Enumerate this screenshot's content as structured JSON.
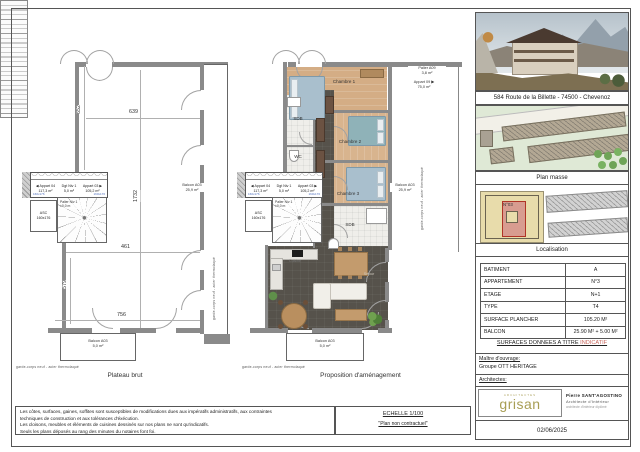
{
  "plans": {
    "left_title": "Plateau brut",
    "right_title": "Proposition d'aménagement",
    "rooms": {
      "chambre1": "Chambre 1",
      "chambre2": "Chambre 2",
      "chambre3": "Chambre 3",
      "sdb": "SDB",
      "wc": "WC",
      "sdb2": "SDB",
      "cuisine": "Cuisine",
      "sejour": "Séjour"
    },
    "labels": {
      "arrow_left": "◀",
      "arrow_right": "▶",
      "appart_04": "Appart 04",
      "appart_04_area": "117,3 m²",
      "appart_03": "Appart 03",
      "appart_03_area": "105,2 m²",
      "dgt_niv1": "Dgt Niv 1",
      "dgt_niv1_area": "5,0 m²",
      "asc": "ASC",
      "asc_dim": "160x176",
      "palier_niv1": "Palier Niv 1",
      "palier_niv1_level": "±0,0 m",
      "palier_a09": "Palier A09",
      "palier_a09_area": "3,8 m²",
      "appart_09": "Appart 09",
      "appart_09_area": "75,0 m²",
      "balcon_side": "Balcon A03",
      "balcon_side_area": "25,9 m²",
      "balcon_bottom": "Balcon A03",
      "balcon_bottom_area": "5,0 m²",
      "garde_corps": "garde-corps neuf - acier thermolaqué"
    },
    "dimensions": {
      "top_width": "639",
      "left_height": "652",
      "full_height": "1732",
      "mid_width": "461",
      "lower_height": "579",
      "bottom_width": "756"
    }
  },
  "title_block": {
    "address": "584 Route de la Billette - 74500 - Chevenoz",
    "plan_masse_caption": "Plan masse",
    "localisation_caption": "Localisation",
    "masse_building_no": "N°03",
    "table": {
      "rows": [
        {
          "label": "BATIMENT",
          "value": "A"
        },
        {
          "label": "APPARTEMENT",
          "value": "N°3"
        },
        {
          "label": "ETAGE",
          "value": "N+1"
        },
        {
          "label": "TYPE",
          "value": "T4"
        },
        {
          "label": "SURFACE PLANCHER",
          "value": "105.20 M²"
        },
        {
          "label": "BALCON",
          "value": "25.90 M² + 5.00 M²"
        }
      ]
    },
    "surfaces_note": "SURFACES DONNEES A TITRE",
    "surfaces_note_accent": "INDICATIF",
    "owner_label": "Maître d'ouvrage:",
    "owner_name": "Groupe OTT HERITAGE",
    "architects_label": "Architectes:",
    "logo_top": "ARCHITECTES",
    "logo_name": "grisan",
    "architect_name": "Pierre SANT'AGOSTINO",
    "architect_role": "Architecte d'Intérieur",
    "architect_note": "architecte d'intérieur diplômé",
    "date": "02/06/2025"
  },
  "footer": {
    "legal_lines": [
      "Les côtes, surfaces, gaines, soffites sont susceptibles de modifications dues aux impératifs administratifs, aux contraintes",
      "techniques de construction et aux tolérances d'éxécution.",
      "Les cloisons, meubles et éléments de cuisines dessinés sur nos plans ne sont qu'indicatifs.",
      "Seuls les plans déposés au rang des minutes du notaires font foi.",
      "scale_note"
    ],
    "scale": "ECHELLE 1/100",
    "contract_note": "\"Plan non contractuel\""
  },
  "colors": {
    "accent_red": "#c8685e",
    "logo_olive": "#a89e55",
    "dim_blue": "#4f6fbe"
  }
}
